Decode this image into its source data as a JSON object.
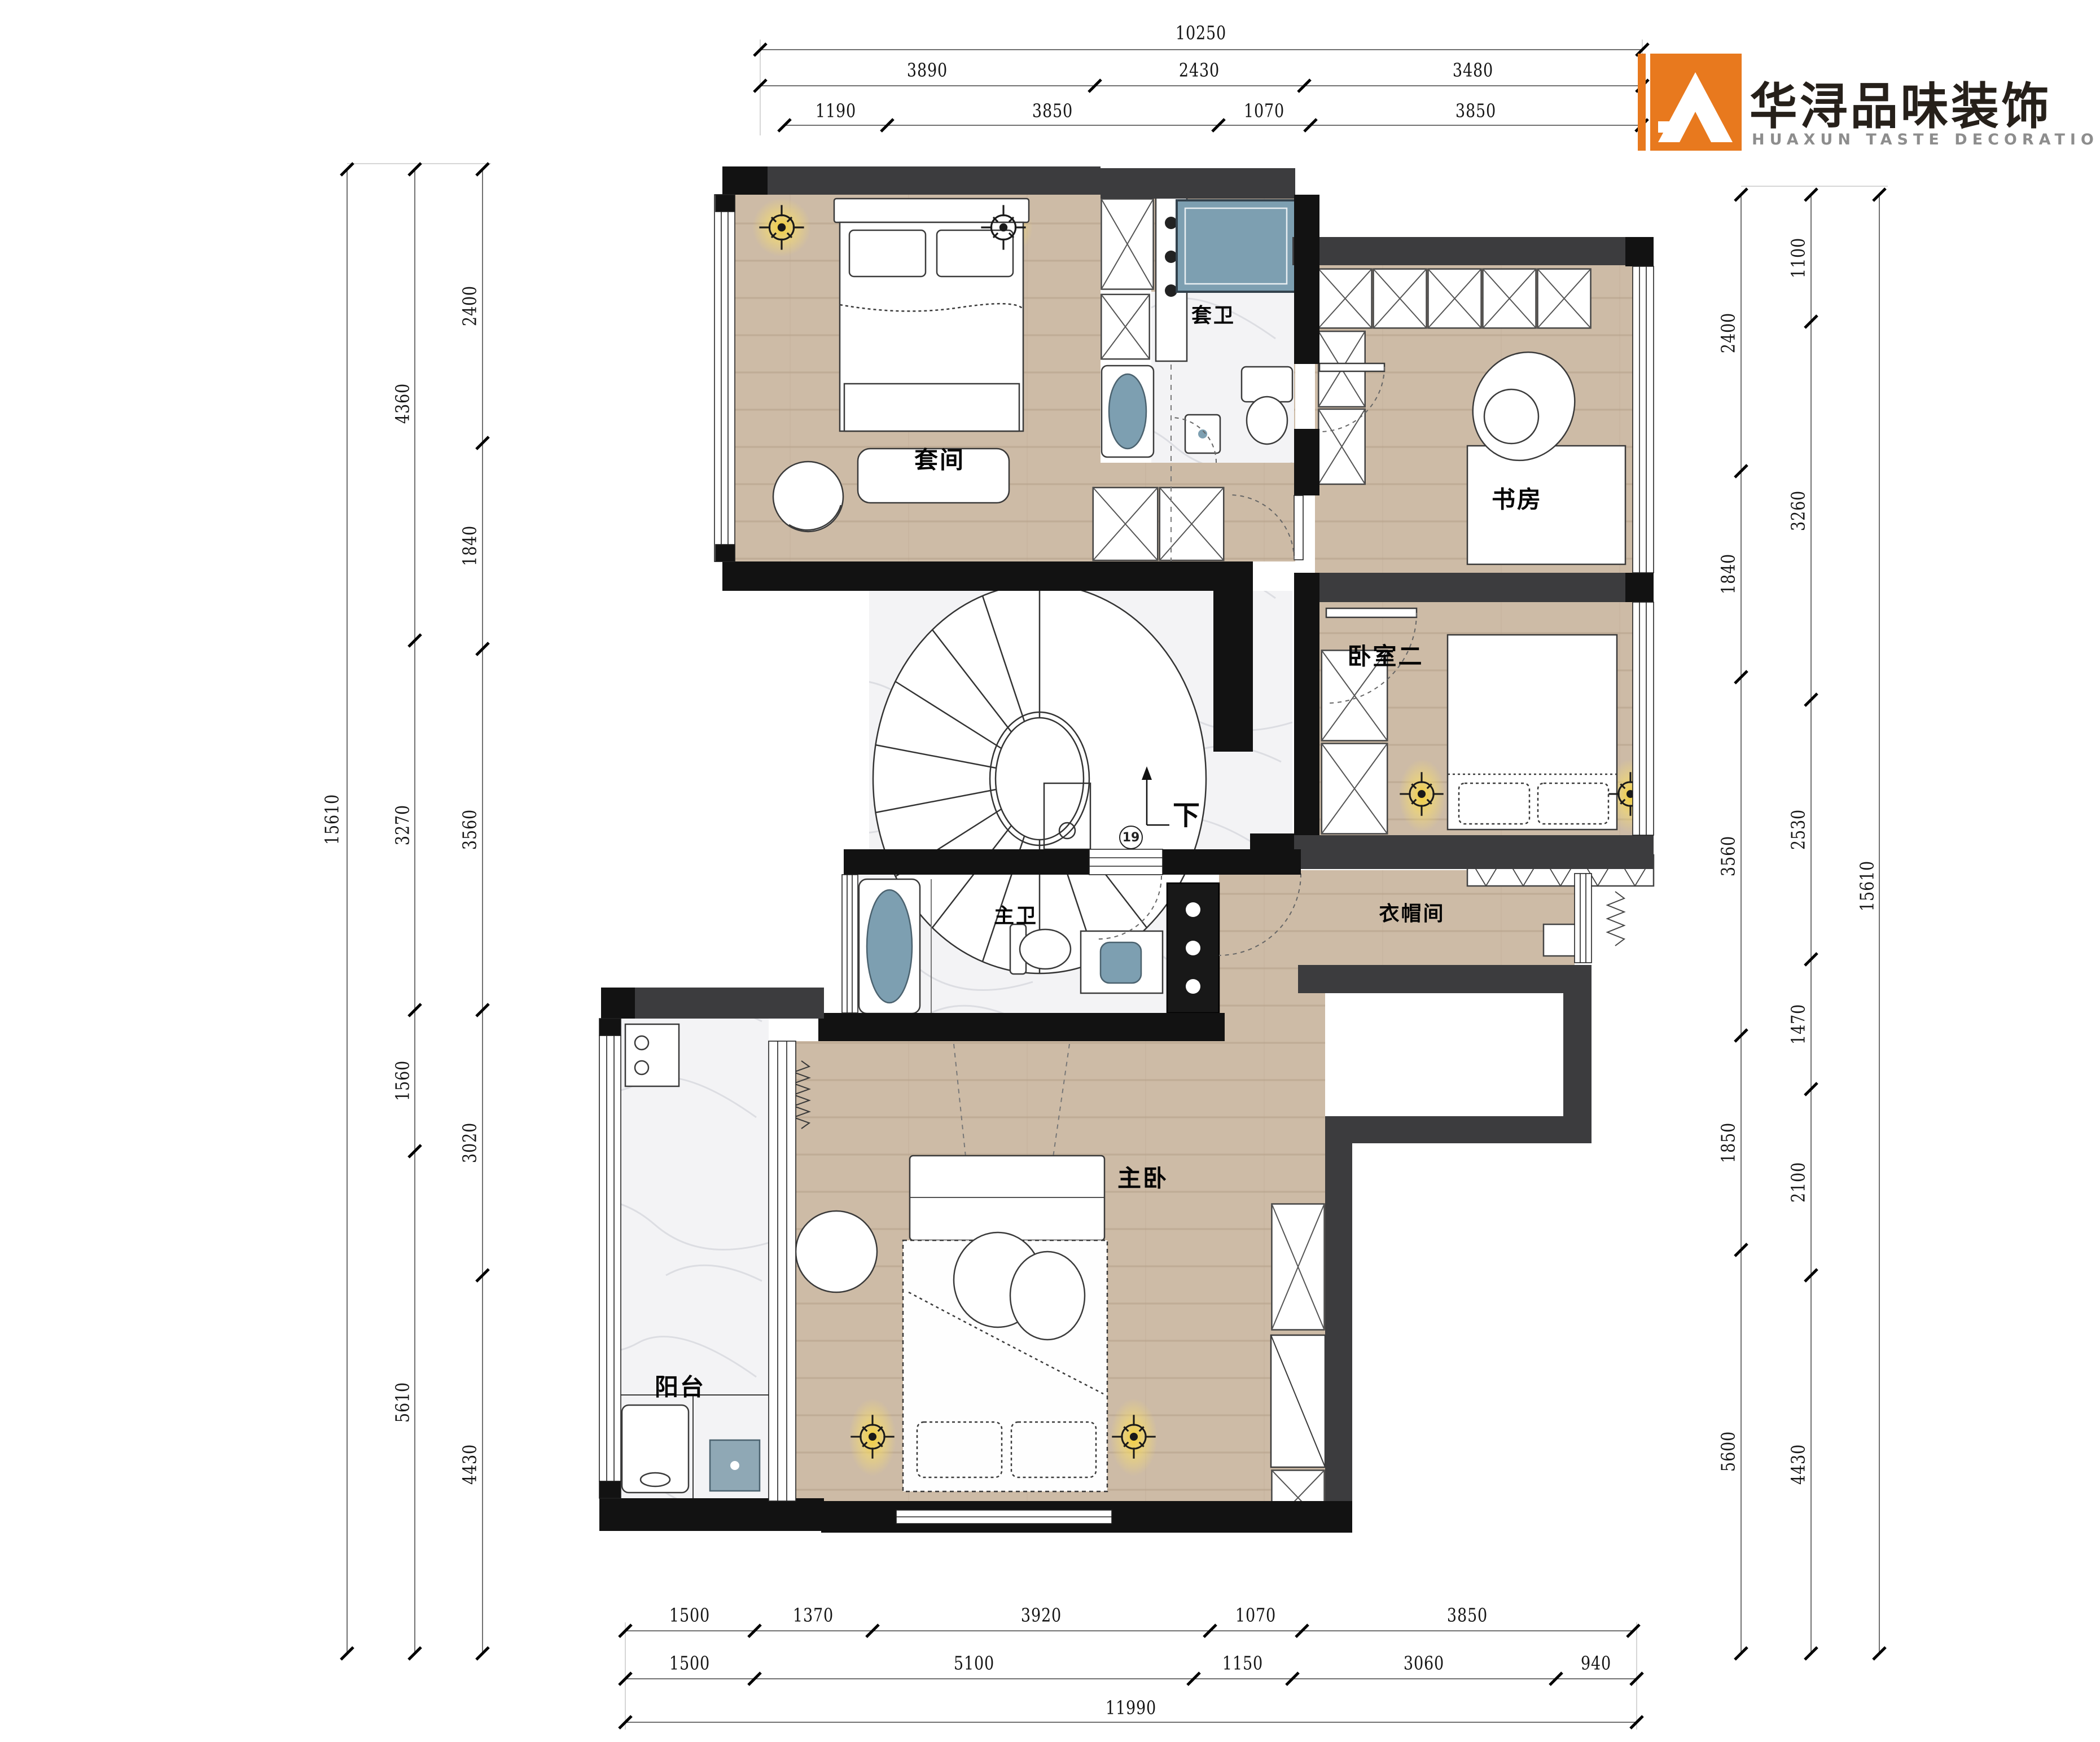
{
  "logo": {
    "zh": "华浔品味装饰",
    "en": "HUAXUN TASTE DECORATION"
  },
  "rooms": {
    "suite": "套间",
    "suite_bath": "套卫",
    "study": "书房",
    "bedroom2": "卧室二",
    "master_bath": "主卫",
    "cloakroom": "衣帽间",
    "master_bedroom": "主卧",
    "balcony": "阳台"
  },
  "stair": {
    "down_label": "下",
    "step_count": "19"
  },
  "dims": {
    "top_total": [
      "10250"
    ],
    "top_mid": [
      "3890",
      "2430",
      "3480"
    ],
    "top_inner": [
      "1190",
      "3850",
      "1070",
      "3850"
    ],
    "left_outer": [
      "15610"
    ],
    "left_mid": [
      "4360",
      "3270",
      "1560",
      "5610"
    ],
    "left_inner": [
      "2400",
      "1840",
      "3560",
      "3020",
      "4430"
    ],
    "right_inner": [
      "2400",
      "1840",
      "3560",
      "1850",
      "5600"
    ],
    "right_mid": [
      "1100",
      "3260",
      "2530",
      "1470",
      "2100",
      "4430"
    ],
    "right_outer": [
      "15610"
    ],
    "bottom_r1": [
      "1500",
      "1370",
      "3920",
      "1070",
      "3850"
    ],
    "bottom_r2": [
      "1500",
      "5100",
      "1150",
      "3060",
      "940"
    ],
    "bottom_total": [
      "11990"
    ]
  },
  "colors": {
    "accent_orange": "#e8791e",
    "wall_gray": "#3c3c3e",
    "wall_black": "#121212",
    "wood_floor": "#cdbba6",
    "marble_floor": "#f3f3f5",
    "fixture_blue": "#7d9fb1",
    "lamp_glow": "#f5cf2f"
  }
}
